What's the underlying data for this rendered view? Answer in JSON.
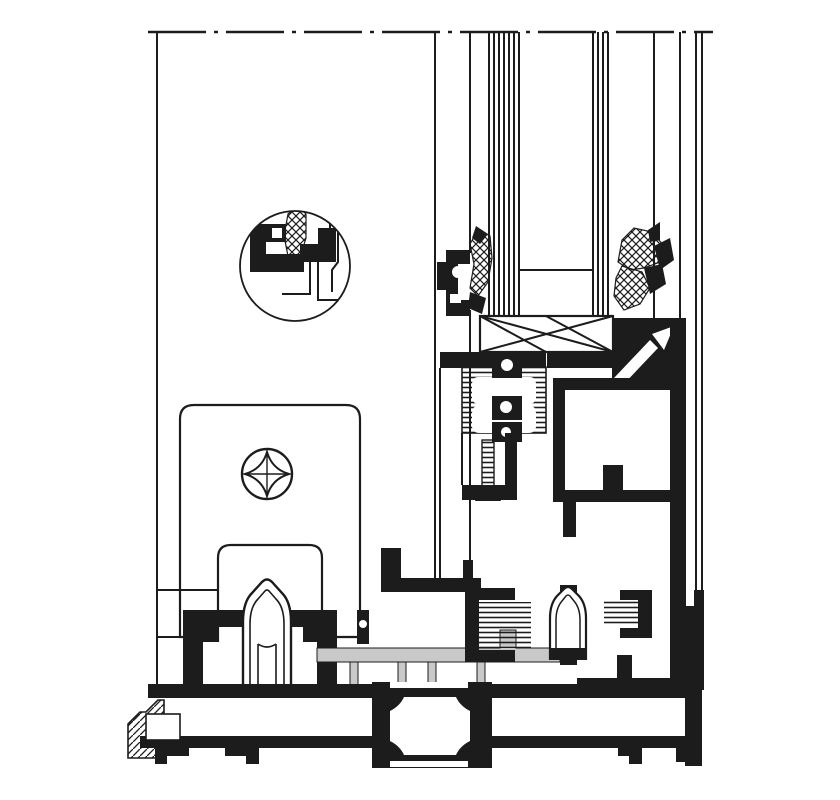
{
  "image": {
    "width": 840,
    "height": 800,
    "description": "Technical cross-section detail drawing of an aluminium sliding-door threshold and frame profile system"
  },
  "colors": {
    "ink": "#1c1c1c",
    "paper": "#ffffff",
    "track_gray": "#c9c9c9",
    "background": "#fdfdfb"
  },
  "components": [
    {
      "id": "break-line",
      "label": "dash-dot section break line at top"
    },
    {
      "id": "glazing-unit",
      "label": "insulated glazing unit with X-braced spacer bar"
    },
    {
      "id": "glazing-gasket-left",
      "label": "cross-hatched glazing gasket, left of glass"
    },
    {
      "id": "glazing-gasket-right",
      "label": "cross-hatched glazing gasket, right of glass"
    },
    {
      "id": "detail-callout-circle",
      "label": "enlarged circular detail of profile interlock with brush seal"
    },
    {
      "id": "cover-plate",
      "label": "rounded cover plate"
    },
    {
      "id": "phillips-screw",
      "label": "Phillips screw head"
    },
    {
      "id": "keeper-plate",
      "label": "inner keeper plate"
    },
    {
      "id": "thermal-break",
      "label": "hatched polyamide thermal break with clip cut-outs"
    },
    {
      "id": "screw-channel",
      "label": "ribbed screw channel"
    },
    {
      "id": "glazing-bead",
      "label": "frame glazing bead with clip arrow"
    },
    {
      "id": "bulb-gasket-left",
      "label": "bulb seal over threshold, left"
    },
    {
      "id": "bulb-gasket-center",
      "label": "bulb seal over threshold, center"
    },
    {
      "id": "brush-seal-left",
      "label": "brush seal in carrier, left"
    },
    {
      "id": "brush-seal-right",
      "label": "brush seal in carrier, right"
    },
    {
      "id": "guide-track",
      "label": "grey guide track insert with tabs"
    },
    {
      "id": "threshold-profile",
      "label": "bottom threshold profile with fixing feet"
    },
    {
      "id": "end-cap",
      "label": "hatched end cap at left of threshold"
    },
    {
      "id": "connector-block",
      "label": "connector block with octagonal bore and hatched corners"
    }
  ]
}
